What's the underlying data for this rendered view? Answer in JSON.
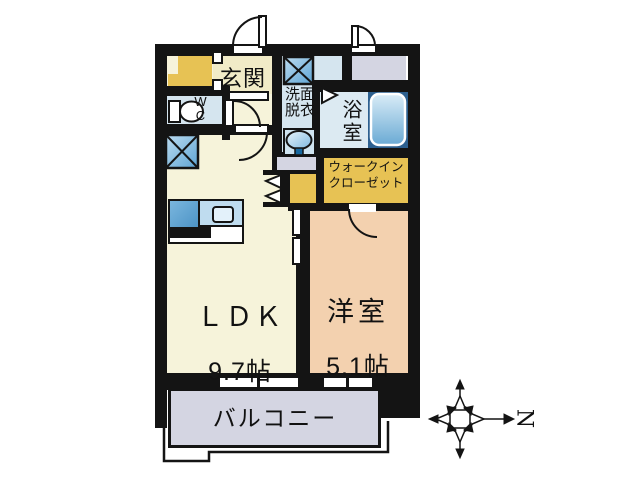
{
  "plan_title": "1LDK apartment floor plan",
  "rooms": {
    "genkan": {
      "label": "玄関"
    },
    "wc": {
      "label": "W\nC"
    },
    "washroom": {
      "label": "洗面\n脱衣"
    },
    "bathroom": {
      "label": "浴室"
    },
    "walk_in_closet": {
      "label": "ウォークイン\nクローゼット"
    },
    "ldk": {
      "label": "ＬＤＫ",
      "size": "9.7帖"
    },
    "western_room": {
      "label": "洋室",
      "size": "5.1帖"
    },
    "balcony": {
      "label": "バルコニー"
    }
  },
  "compass": {
    "label": "N"
  },
  "colors": {
    "wall": "#141414",
    "cream": "#f6f3da",
    "genkan": "#f1ebc7",
    "gold": "#e7c254",
    "roomblue": "#d5e5ef",
    "bathblue": "#dceaf2",
    "tubsurround": "#2d608f",
    "peach": "#f3d1af",
    "gray": "#d4d5e2"
  }
}
